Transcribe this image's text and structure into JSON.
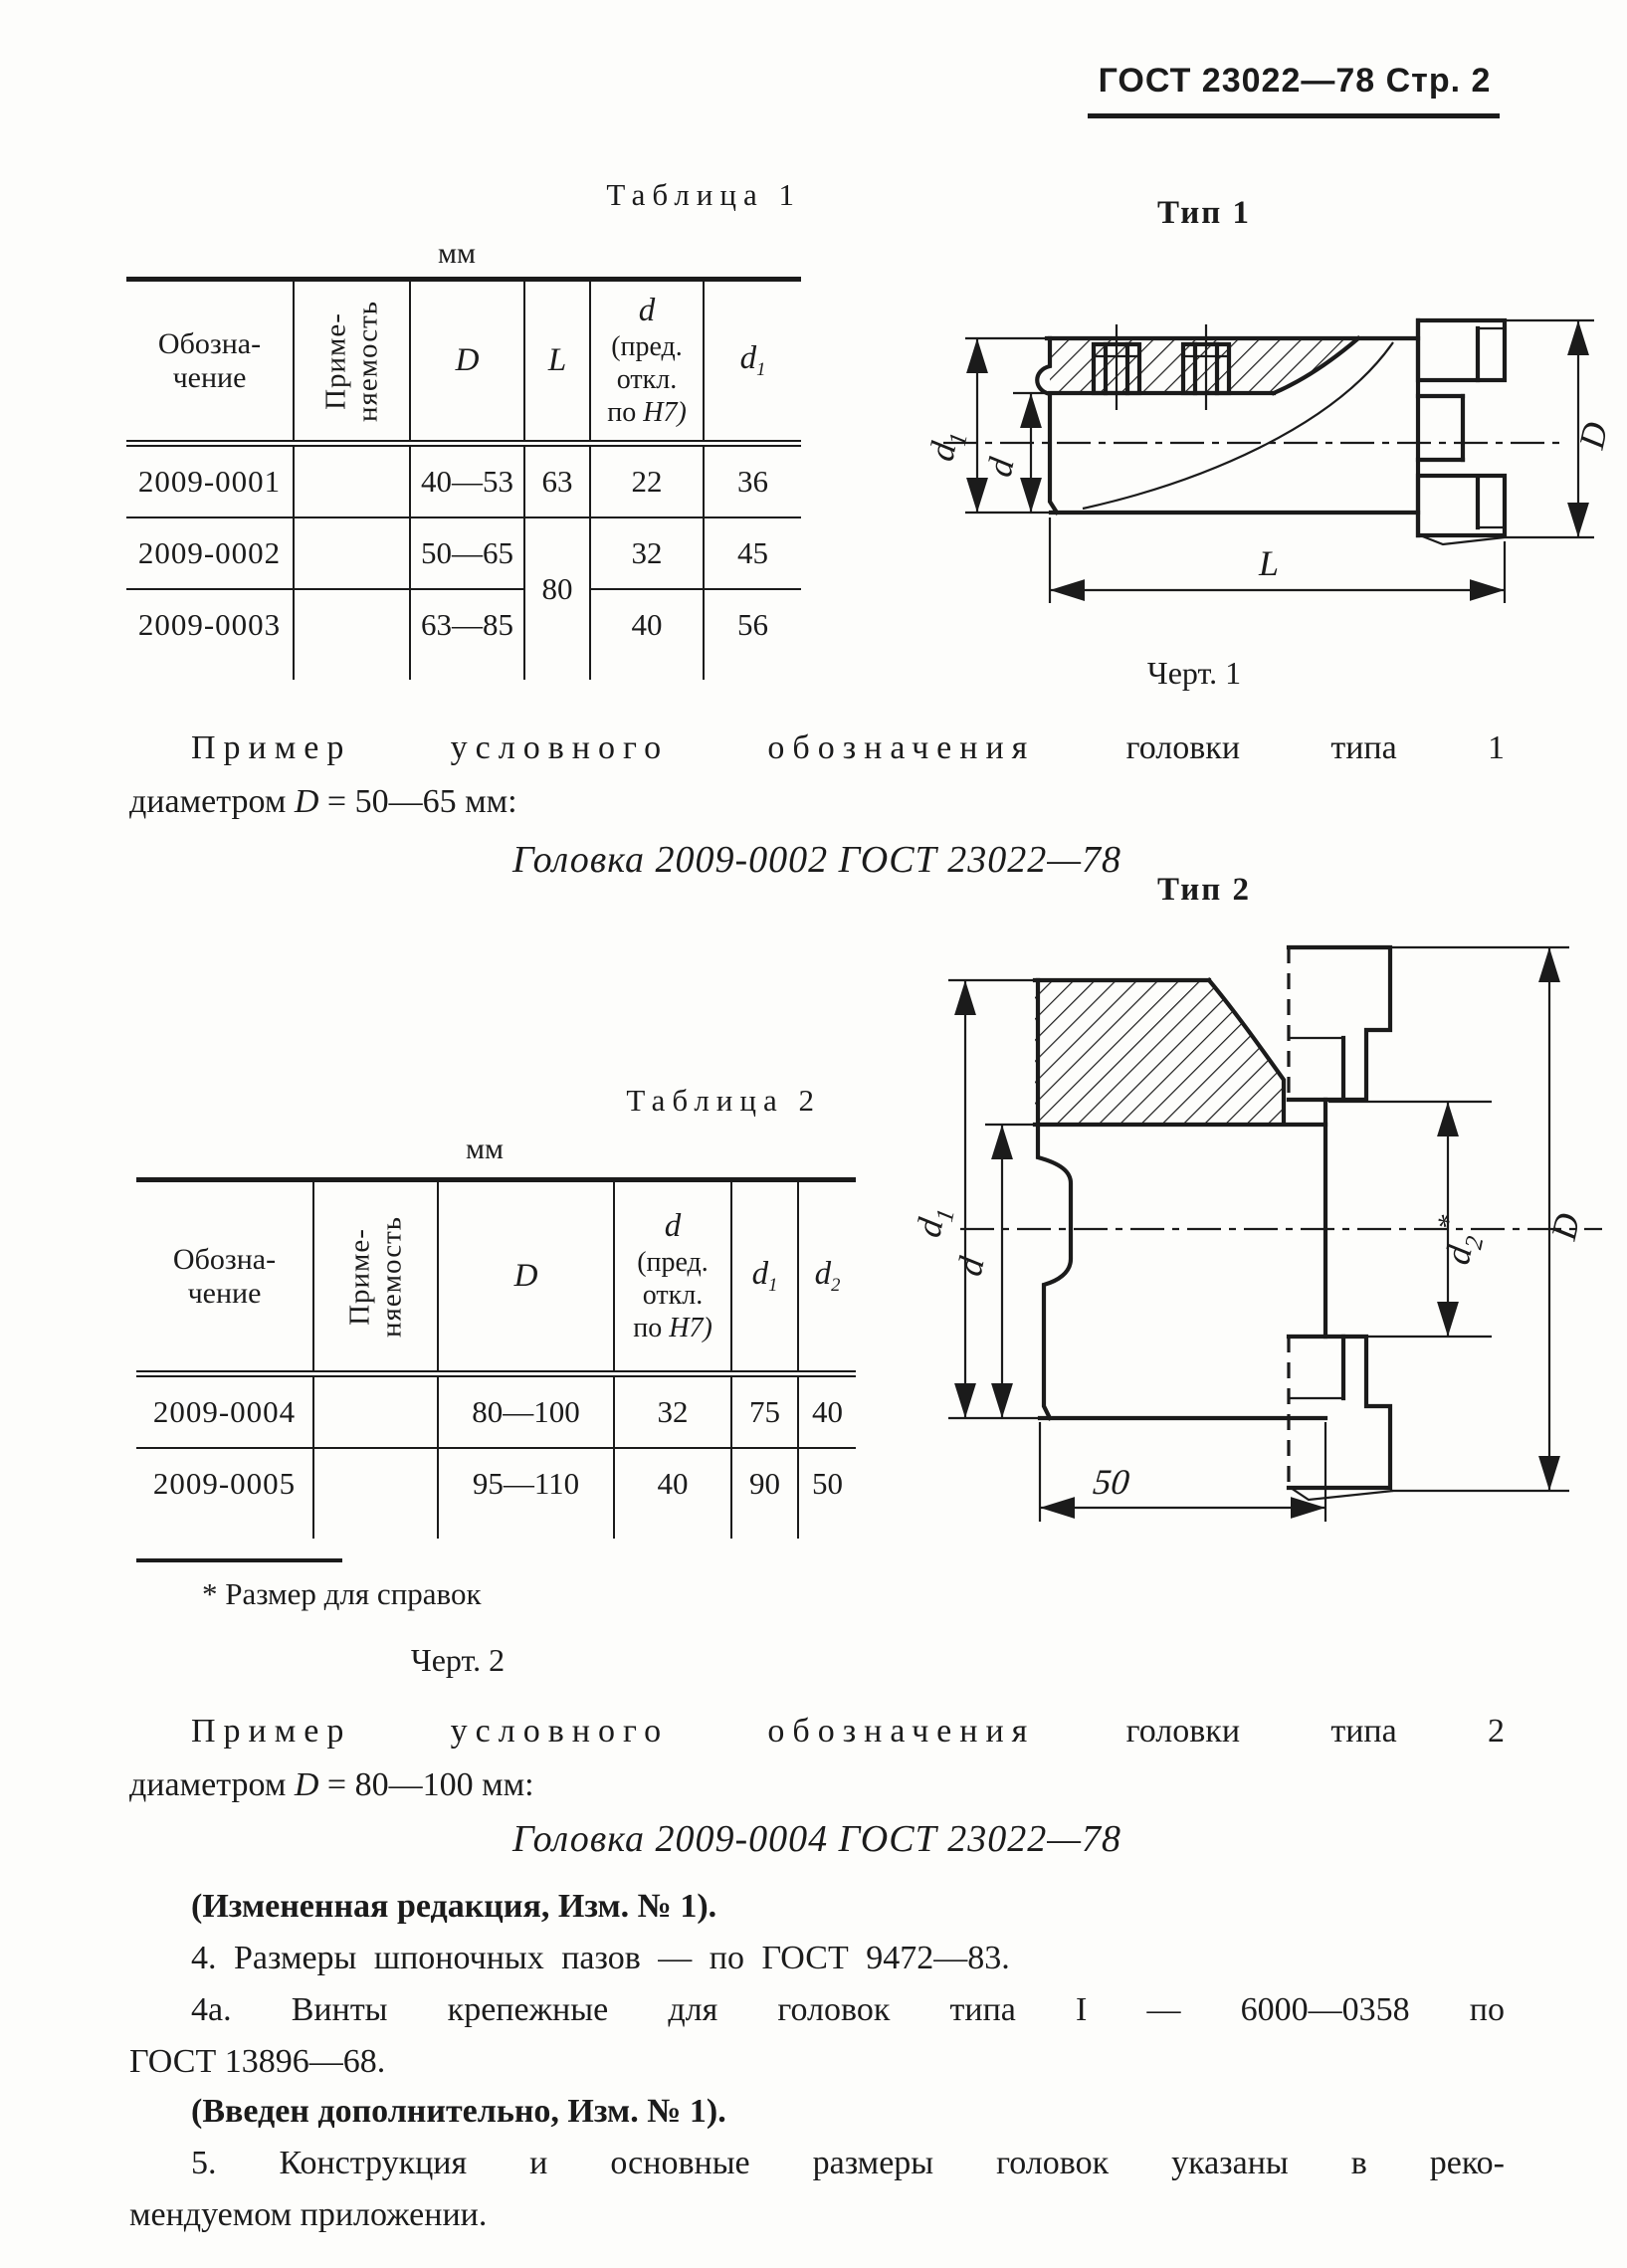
{
  "page": {
    "background": "#fdfdfb",
    "ink": "#1b1b1b"
  },
  "header": {
    "title": "ГОСТ 23022—78 Стр. 2"
  },
  "table1": {
    "caption": "Таблица 1",
    "unit": "мм",
    "headers": {
      "obozn": "Обозна-\nчение",
      "primen": "Приме-\nняемость",
      "D": "D",
      "L": "L",
      "d_sym": "d",
      "d_l1": "(пред.",
      "d_l2": "откл.",
      "d_l3_pre": "по",
      "d_l3_sym": "H7)",
      "d1_base": "d",
      "d1_sub": "1"
    },
    "rows": [
      {
        "name": "2009-0001",
        "D": "40—53",
        "L": "63",
        "d": "22",
        "d1": "36"
      },
      {
        "name": "2009-0002",
        "D": "50—65",
        "L": "80",
        "d": "32",
        "d1": "45"
      },
      {
        "name": "2009-0003",
        "D": "63—85",
        "d": "40",
        "d1": "56"
      }
    ]
  },
  "table2": {
    "caption": "Таблица 2",
    "unit": "мм",
    "headers": {
      "obozn": "Обозна-\nчение",
      "primen": "Приме-\nняемость",
      "D": "D",
      "d_sym": "d",
      "d_l1": "(пред.",
      "d_l2": "откл.",
      "d_l3_pre": "по",
      "d_l3_sym": "H7)",
      "d1_base": "d",
      "d1_sub": "1",
      "d2_base": "d",
      "d2_sub": "2"
    },
    "rows": [
      {
        "name": "2009-0004",
        "D": "80—100",
        "d": "32",
        "d1": "75",
        "d2": "40"
      },
      {
        "name": "2009-0005",
        "D": "95—110",
        "d": "40",
        "d1": "90",
        "d2": "50"
      }
    ],
    "footnote": "* Размер для справок"
  },
  "fig1": {
    "type_label": "Тип 1",
    "caption": "Черт. 1",
    "dim_d1_base": "d",
    "dim_d1_sub": "1",
    "dim_d": "d",
    "dim_D": "D",
    "dim_L": "L"
  },
  "fig2": {
    "type_label": "Тип 2",
    "caption": "Черт. 2",
    "dim_d1_base": "d",
    "dim_d1_sub": "1",
    "dim_d": "d",
    "dim_d2_base": "d",
    "dim_d2_sub": "2",
    "dim_d2_star": "*",
    "dim_D": "D",
    "dim_len": "50"
  },
  "example1": {
    "spaced": "Пример условного обозначения",
    "rest": "головки типа 1",
    "line2_pre": "диаметром",
    "line2_sym": "D",
    "line2_post": "= 50—65 мм:",
    "designation": "Головка 2009-0002 ГОСТ 23022—78"
  },
  "example2": {
    "spaced": "Пример условного обозначения",
    "rest": "головки типа 2",
    "line2_pre": "диаметром",
    "line2_sym": "D",
    "line2_post": "= 80—100 мм:",
    "designation": "Головка 2009-0004 ГОСТ 23022—78"
  },
  "notes": {
    "changed": "(Измененная редакция, Изм. № 1).",
    "p4": "4. Размеры шпоночных пазов — по ГОСТ 9472—83.",
    "p4a_l1": "4а. Винты крепежные для головок типа I — 6000—0358 по",
    "p4a_l2": "ГОСТ 13896—68.",
    "added": "(Введен дополнительно, Изм. № 1).",
    "p5_l1": "5. Конструкция и основные размеры головок указаны в реко-",
    "p5_l2": "мендуемом приложении."
  }
}
